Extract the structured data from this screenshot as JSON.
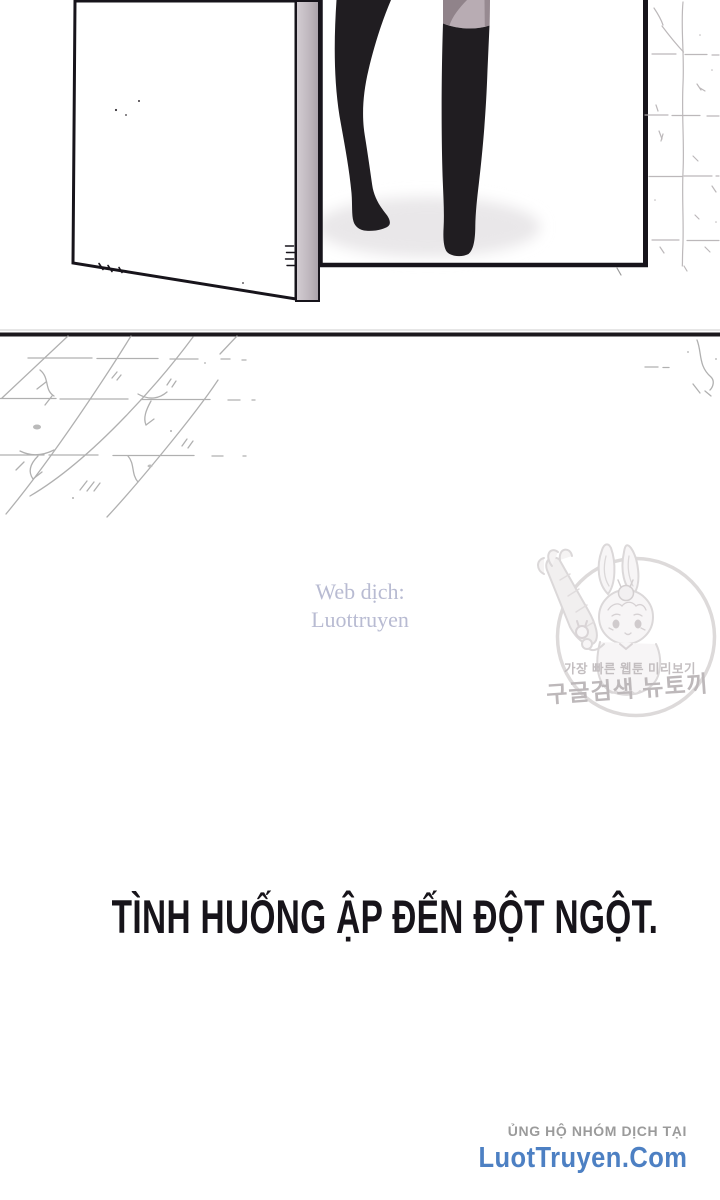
{
  "panel": {
    "description": "open white door with gray edge, doorway with legs in black thigh-high boots stepping in, sketched stone wall right, sketched tiled floor below"
  },
  "credits": {
    "translator_line1": "Web dịch:",
    "translator_line2": "Luottruyen",
    "support_label": "ỦNG HỘ NHÓM DỊCH TẠI",
    "site_name": "LuotTruyen.Com"
  },
  "caption": {
    "text": "TÌNH HUỐNG ẬP ĐẾN ĐỘT NGỘT."
  },
  "watermark": {
    "line1": "가장 빠른 웹툰 미리보기",
    "line2": "구글검색 뉴토끼"
  },
  "colors": {
    "ink_black": "#1b181c",
    "caption_black": "#17141a",
    "site_link_blue": "#4d80c3",
    "support_gray": "#9b9b9b",
    "translator_lavender": "#b8bbd2",
    "watermark_gray": "#b6b1b3",
    "door_edge_gray": "#c0b9bf",
    "thigh_light": "#b8acb3",
    "thigh_dark": "#90838a",
    "sketch_gray": "#a8a8a8"
  }
}
